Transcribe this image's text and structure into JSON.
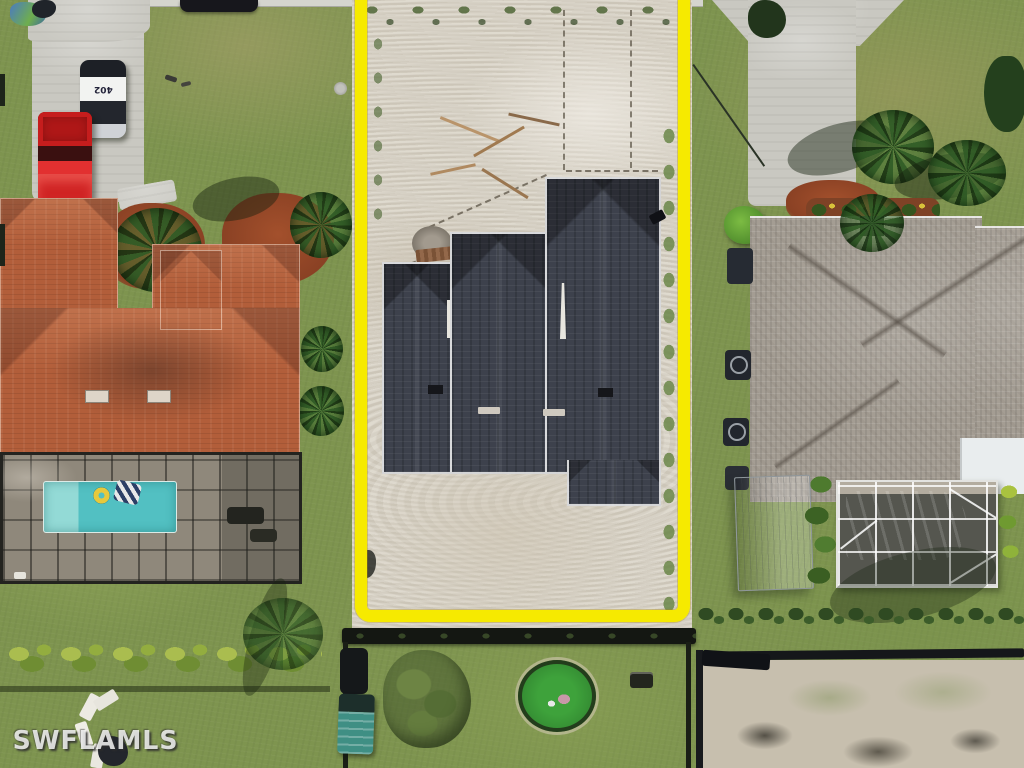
{
  "scene": {
    "type": "aerial-drone-photo",
    "description": "Top-down aerial photo of a residential street: a vacant construction lot outlined in yellow (new dark-shingle roof home mid-build on graded sand) flanked by a tile-roof home with screened pool on the left and a gray-shingle home with covered pool and shed on the right; rear fenced lots below.",
    "watermark": "SWFLAMLS",
    "police_car_number": "402"
  },
  "colors": {
    "lot_outline": "#f6ea00",
    "grass_base": "#7e944f",
    "sand_lot": "#d8d2c5",
    "construction_roof": "#3d414c",
    "left_house_tile_roof": "#b25e3a",
    "right_house_roof": "#a49d93",
    "left_pool_water": "#52c0c2",
    "right_pool_cover": "#2d67bb",
    "driveway_concrete": "#c9c8c1",
    "red_truck": "#d42222",
    "teal_truck": "#3f8f84",
    "mulch": "#96492a"
  }
}
